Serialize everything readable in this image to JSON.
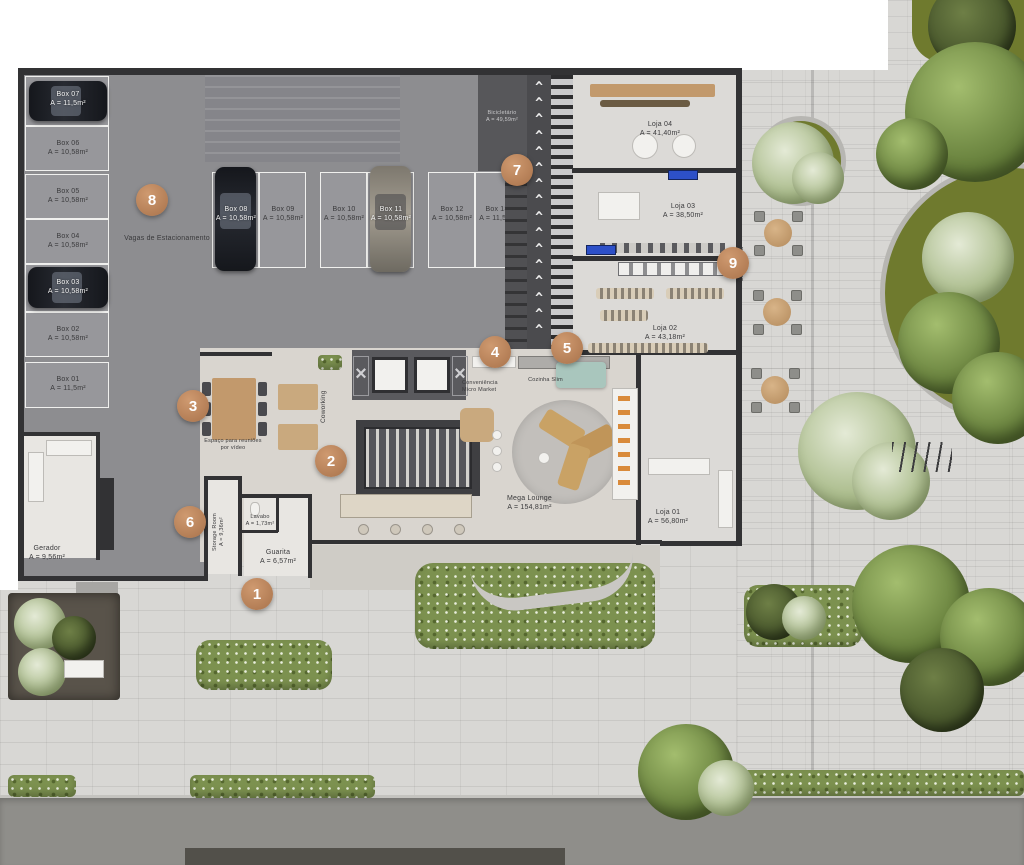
{
  "legend": {
    "markers": [
      "1",
      "2",
      "3",
      "4",
      "5",
      "6",
      "7",
      "8",
      "9"
    ]
  },
  "parking": {
    "caption": "Vagas de Estacionamento",
    "left": [
      "Box 07\nA = 11,5m²",
      "Box 06\nA = 10,58m²",
      "Box 05\nA = 10,58m²",
      "Box 04\nA = 10,58m²",
      "Box 03\nA = 10,58m²",
      "Box 02\nA = 10,58m²",
      "Box 01\nA = 11,5m²"
    ],
    "mid": [
      "Box 08\nA = 10,58m²",
      "Box 09\nA = 10,58m²",
      "Box 10\nA = 10,58m²",
      "Box 11\nA = 10,58m²",
      "Box 12\nA = 10,58m²",
      "Box 13\nA = 11,5m²"
    ]
  },
  "rooms": {
    "bicicletario": "Bicicletário\nA = 49,59m²",
    "loja04": "Loja 04\nA = 41,40m²",
    "loja03": "Loja 03\nA = 38,50m²",
    "loja02": "Loja 02\nA = 43,18m²",
    "loja01": "Loja 01\nA = 56,80m²",
    "lavanderia": "Lavanderia",
    "megalounge": "Mega Lounge\nA = 154,81m²",
    "conveniencia": "Conveniência\nMicro Market",
    "cozinha": "Cozinha Slim",
    "coworking": "Coworking",
    "reunioes": "Espaço para reuniões\npor vídeo",
    "gerador": "Gerador\nA = 9,56m²",
    "storage": "Storage Room\nA = 9,36m²",
    "lavabo": "Lavabo\nA = 1,73m²",
    "guarita": "Guarita\nA = 6,57m²"
  },
  "glyphs": {
    "ramp_arrows": "^\n^\n^\n^\n^\n^\n^\n^\n^\n^\n^\n^\n^\n^\n^\n^",
    "elevator_brace": "×"
  },
  "colors": {
    "marker": "#bf8a64",
    "wall": "#323234",
    "garage_floor": "#8d8d90",
    "lounge_floor": "#d9d5cf",
    "sidewalk": "#d8d7d4",
    "road": "#8f8e8a",
    "green": "#7c914f",
    "accent_blue": "#2d50c8"
  }
}
